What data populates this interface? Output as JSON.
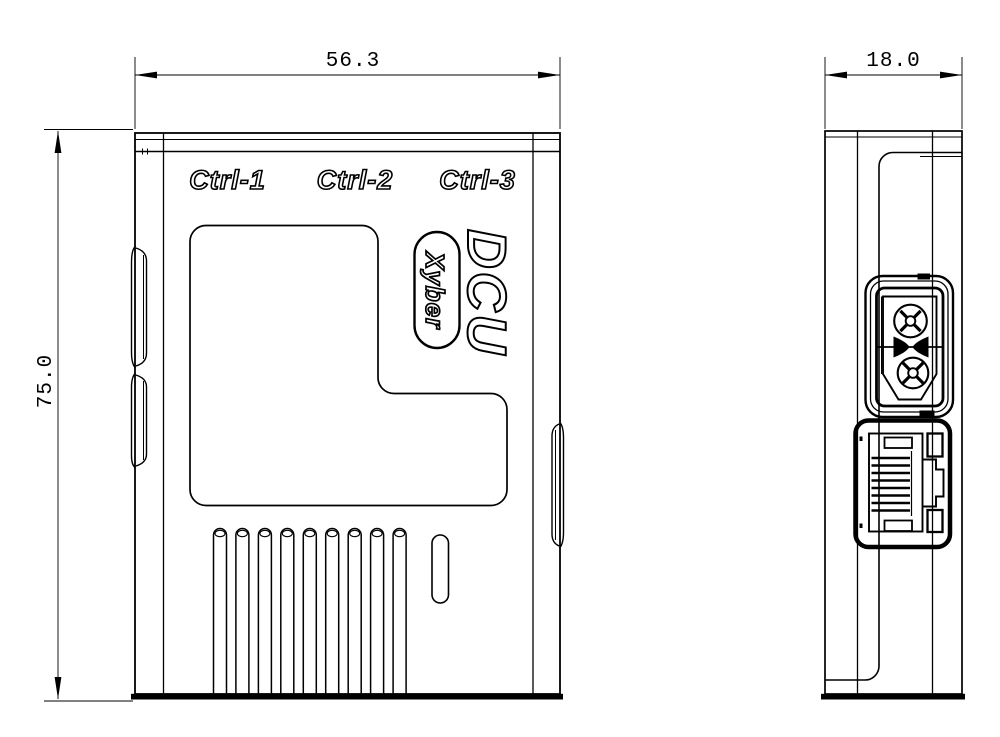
{
  "colors": {
    "background": "#ffffff",
    "line": "#000000"
  },
  "labels": {
    "ctrl_ports": [
      "Ctrl-1",
      "Ctrl-2",
      "Ctrl-3"
    ],
    "model": "DCU",
    "brand": "Xyber"
  },
  "dimensions": {
    "front_width_mm": "56.3",
    "front_height_mm": "75.0",
    "side_depth_mm": "18.0"
  }
}
